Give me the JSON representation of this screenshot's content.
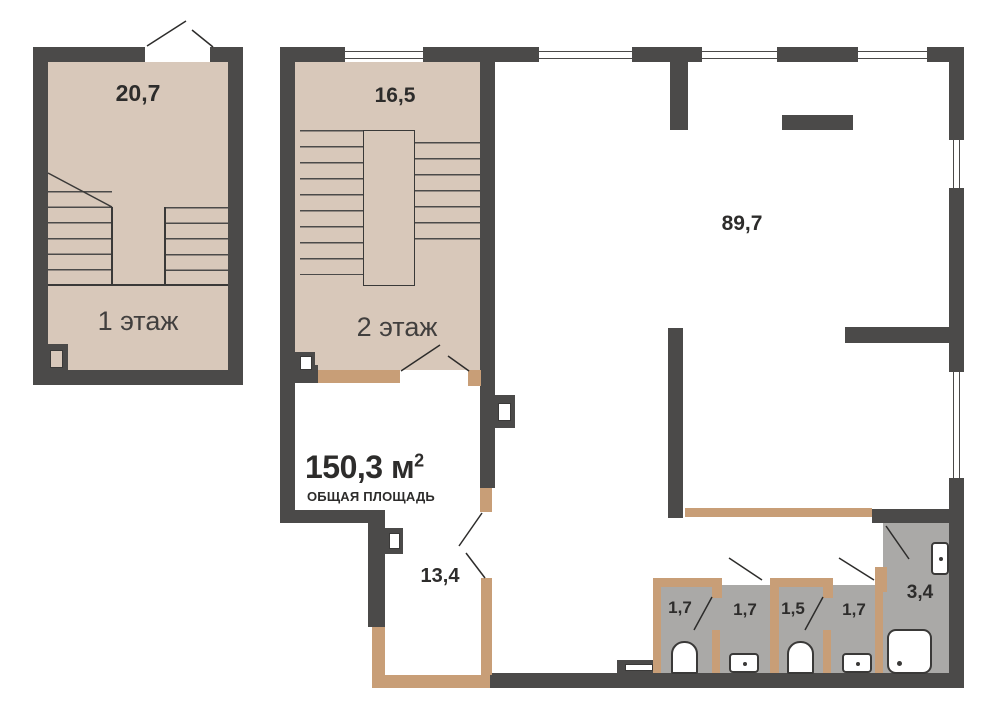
{
  "plan": {
    "floor1": {
      "floor_label": "1 этаж",
      "room_area": "20,7"
    },
    "floor2": {
      "floor_label": "2 этаж",
      "stair_room_area": "16,5",
      "living_room_area": "89,7",
      "hall_area": "13,4",
      "wet_rooms": [
        {
          "area": "1,7"
        },
        {
          "area": "1,7"
        },
        {
          "area": "1,5"
        },
        {
          "area": "1,7"
        },
        {
          "area": "3,4"
        }
      ]
    },
    "total_area": {
      "value": "150,3 м",
      "sup": "2",
      "label": "ОБЩАЯ ПЛОЩАДЬ"
    }
  },
  "colors": {
    "wall": "#4b4a49",
    "floor_beige": "#d8c8ba",
    "partition_tan": "#c89e77",
    "floor_gray": "#aaa9a7",
    "floor_white": "#ffffff",
    "text": "#2d2c2b"
  }
}
